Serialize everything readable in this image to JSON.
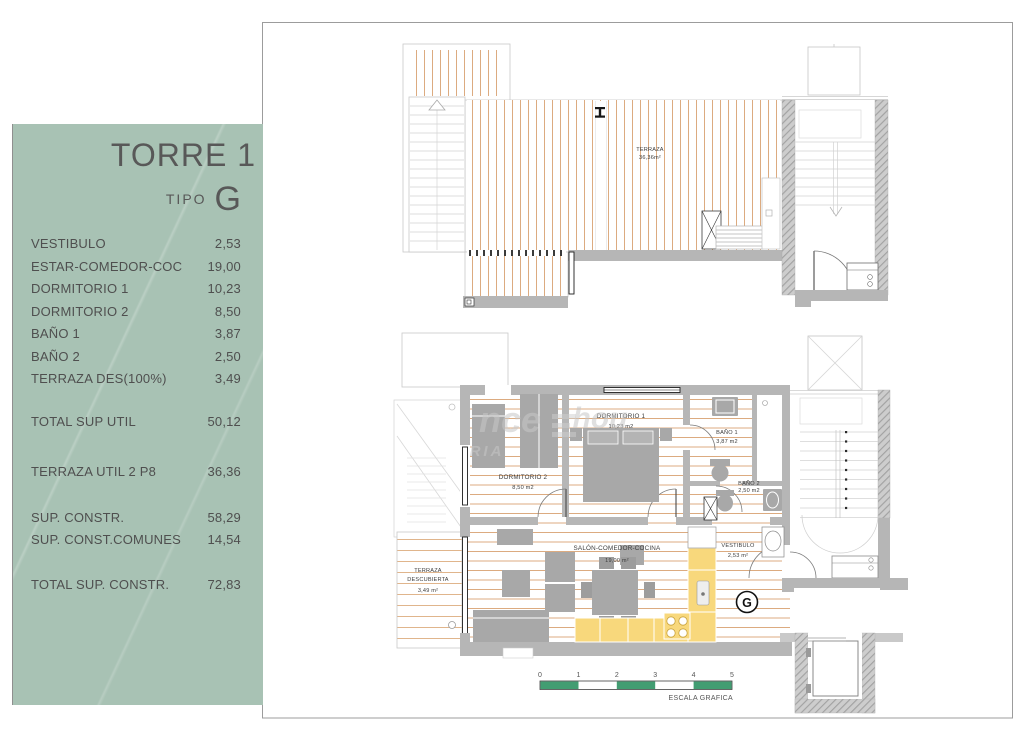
{
  "panel": {
    "title": "TORRE 1",
    "tipo_label": "TIPO",
    "tipo_value": "G",
    "rows": [
      {
        "label": "VESTIBULO",
        "value": "2,53"
      },
      {
        "label": "ESTAR-COMEDOR-COC",
        "value": "19,00"
      },
      {
        "label": "DORMITORIO 1",
        "value": "10,23"
      },
      {
        "label": "DORMITORIO 2",
        "value": "8,50"
      },
      {
        "label": "BAÑO 1",
        "value": "3,87"
      },
      {
        "label": "BAÑO 2",
        "value": "2,50"
      },
      {
        "label": "TERRAZA DES(100%)",
        "value": "3,49"
      },
      {
        "label": "TOTAL SUP UTIL",
        "value": "50,12"
      },
      {
        "label": "TERRAZA UTIL 2 P8",
        "value": "36,36"
      },
      {
        "label": "SUP. CONSTR.",
        "value": "58,29"
      },
      {
        "label": "SUP. CONST.COMUNES",
        "value": "14,54"
      },
      {
        "label": "TOTAL SUP. CONSTR.",
        "value": "72,83"
      }
    ]
  },
  "upper_plan": {
    "terraza": {
      "name": "TERRAZA",
      "area": "36,36m²"
    }
  },
  "lower_plan": {
    "dormitorio1": {
      "name": "DORMITORIO 1",
      "area": "10,23 m2"
    },
    "dormitorio2": {
      "name": "DORMITORIO 2",
      "area": "8,50 m2"
    },
    "bano1": {
      "name": "BAÑO 1",
      "area": "3,87 m2"
    },
    "bano2": {
      "name": "BAÑO 2",
      "area": "2,50 m2"
    },
    "vestibulo": {
      "name": "VESTIBULO",
      "area": "2,53 m²"
    },
    "salon": {
      "name": "SALÓN-COMEDOR-COCINA",
      "area": "19,00 m²"
    },
    "terraza_descubierta": {
      "line1": "TERRAZA",
      "line2": "DESCUBIERTA",
      "area": "3,49 m²"
    },
    "unit_marker": "G"
  },
  "watermark": {
    "part1": "nce",
    "part2": "hou",
    "part3": "RIA"
  },
  "scale_bar": {
    "ticks": [
      "0",
      "1",
      "2",
      "3",
      "4",
      "5"
    ],
    "label": "ESCALA GRAFICA"
  },
  "colors": {
    "panel_green": "#a8c2b4",
    "scale_green": "#429d72",
    "kitchen_yellow": "#f8d87c",
    "floor_stripe": "#dcab80",
    "wall_gray": "#b6b6b6"
  }
}
